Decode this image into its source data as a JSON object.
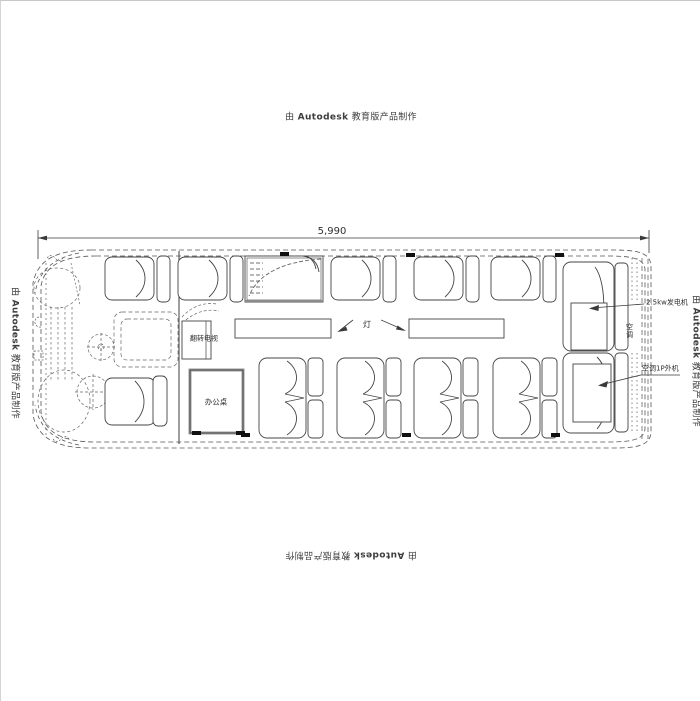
{
  "watermark": {
    "prefix": "由",
    "brand": "Autodesk",
    "suffix": "教育版产品制作"
  },
  "dimension": {
    "overall_length": "5,990"
  },
  "labels": {
    "flip_tv": "翻转电视",
    "office_desk": "办公桌",
    "light": "灯",
    "generator": "2.5kw发电机",
    "air_conditioner": "空调",
    "ac_outdoor_unit": "空调1P外机"
  }
}
